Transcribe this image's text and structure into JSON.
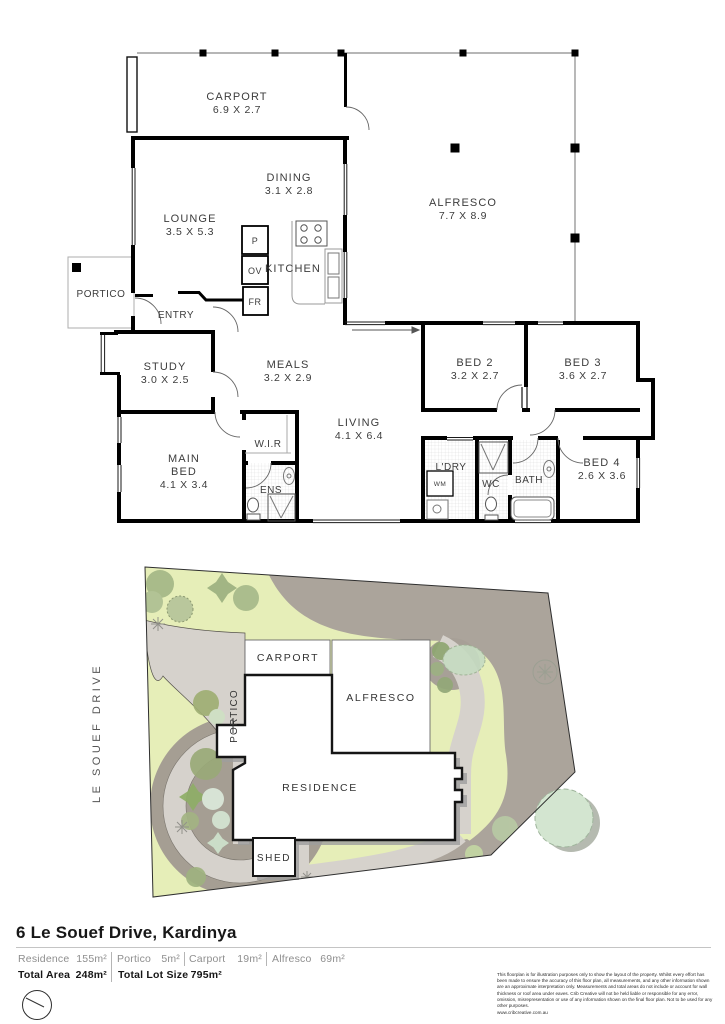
{
  "floorplan": {
    "rooms": [
      {
        "name": "CARPORT",
        "dims": "6.9 X 2.7"
      },
      {
        "name": "DINING",
        "dims": "3.1 X 2.8"
      },
      {
        "name": "ALFRESCO",
        "dims": "7.7 X 8.9"
      },
      {
        "name": "LOUNGE",
        "dims": "3.5 X 5.3"
      },
      {
        "name": "KITCHEN"
      },
      {
        "name": "PORTICO"
      },
      {
        "name": "ENTRY"
      },
      {
        "name": "STUDY",
        "dims": "3.0 X 2.5"
      },
      {
        "name": "MEALS",
        "dims": "3.2 X 2.9"
      },
      {
        "name": "BED 2",
        "dims": "3.2 X 2.7"
      },
      {
        "name": "BED 3",
        "dims": "3.6 X 2.7"
      },
      {
        "name": "LIVING",
        "dims": "4.1 X 6.4"
      },
      {
        "name": "W.I.R"
      },
      {
        "name": "MAIN",
        "name2": "BED",
        "dims": "4.1 X 3.4"
      },
      {
        "name": "ENS"
      },
      {
        "name": "L'DRY"
      },
      {
        "name": "WC"
      },
      {
        "name": "BATH"
      },
      {
        "name": "BED 4",
        "dims": "2.6 X 3.6"
      }
    ],
    "appliances": {
      "pantry": "P",
      "oven": "OV",
      "fridge": "FR",
      "washer": "WM"
    }
  },
  "siteplan": {
    "street": "LE SOUEF DRIVE",
    "labels": {
      "carport": "CARPORT",
      "alfresco": "ALFRESCO",
      "residence": "RESIDENCE",
      "portico": "PORTICO",
      "shed": "SHED"
    }
  },
  "footer": {
    "address": "6 Le Souef Drive, Kardinya",
    "stats": [
      {
        "label": "Residence",
        "value": "155m²"
      },
      {
        "label": "Portico",
        "value": "5m²"
      },
      {
        "label": "Carport",
        "value": "19m²"
      },
      {
        "label": "Alfresco",
        "value": "69m²"
      }
    ],
    "totals": [
      {
        "label": "Total Area",
        "value": "248m²"
      },
      {
        "label": "Total Lot Size",
        "value": "795m²"
      }
    ],
    "disclaimer": "This floorplan is for illustration purposes only to show the layout of the property. Whilst every effort has been made to ensure the accuracy of this floor plan, all measurements, and any other information shown are an approximate interpretation only. Measurements and total areas do not include or account for wall thickness or roof area under eaves. Crib Creative will not be held liable or responsible for any error, omission, misrepresentation or use of any information shown on the final floor plan. Not to be used for any other purposes.",
    "website": "www.cribcreative.com.au"
  },
  "colors": {
    "walls": "#000000",
    "lawn": "#e6eeb8",
    "paving": "#d6d2cc",
    "mulch": "#a59e93",
    "border_band": "#aba49b",
    "tree_olive": "#9aaa78",
    "tree_pale": "#d3e5d0"
  }
}
